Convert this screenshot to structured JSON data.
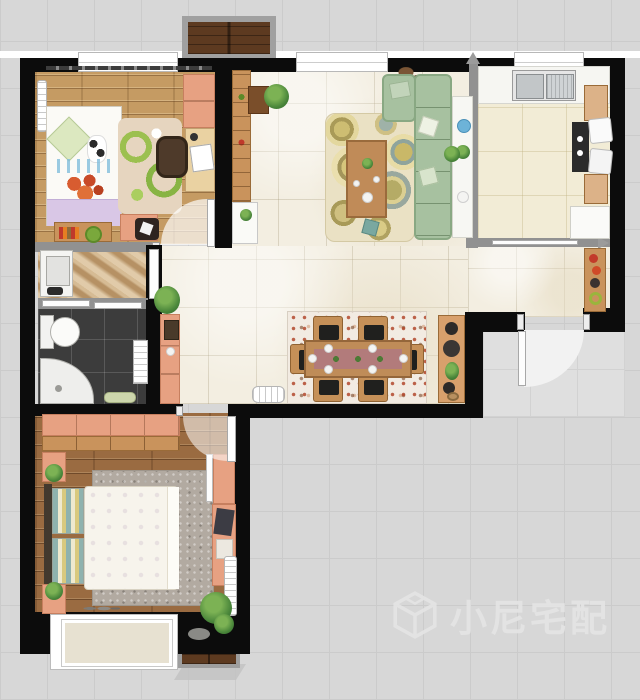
{
  "watermark": {
    "text": "小尼宅配",
    "logo": "cube-logo-icon",
    "color": "#e5e5e5"
  },
  "palette": {
    "exterior_bg": "#d7d7d7",
    "exterior_grid": "#cbcbcb",
    "wall_black": "#0c0c0c",
    "partition_gray": "#919191",
    "cream_marble_tile": "#f3eee1",
    "kitchen_tile": "#f2ecd6",
    "light_wood_floor": "#c59b63",
    "dark_wood_floor": "#9a6b41",
    "walnut_balcony": "#5d3a20",
    "marble_beige": "#c8a77a",
    "bath_tile_dark": "#3c3c3c",
    "fixture_white": "#ffffff",
    "sofa_green": "#a7c1a0",
    "salmon_furniture": "#e7a182",
    "furniture_wood": "#c9935c",
    "living_rug_base": "#eae1c4",
    "dining_rug_base": "#f2ebe2",
    "master_rug_gray": "#b2aaa1",
    "lavender_bedding": "#d9c7e6",
    "door_fan": "#f2f2f2"
  },
  "floorplan": {
    "rooms": [
      {
        "name": "secondary-bedroom",
        "floor": "light-wood-plank",
        "furniture": [
          "single-bed",
          "diamond-pillow",
          "flower-throw",
          "lavender-runner",
          "green-swirl-rug",
          "desk",
          "monitor",
          "desk-chair",
          "wardrobe",
          "radiator",
          "curtain-rail",
          "dresser",
          "side-table",
          "black-chair",
          "hinged-door"
        ]
      },
      {
        "name": "top-balcony",
        "floor": "walnut-plank",
        "furniture": []
      },
      {
        "name": "living-room",
        "floor": "cream-marble-tile",
        "furniture": [
          "l-shaped-green-sofa",
          "throw-pillows",
          "circle-pattern-rug",
          "coffee-table",
          "tea-set",
          "console-table",
          "blue-cup",
          "bookshelf",
          "low-cabinet",
          "bush-plant",
          "dried-plant",
          "teal-stool"
        ]
      },
      {
        "name": "kitchen",
        "floor": "cream-tile",
        "furniture": [
          "double-basin-sink",
          "counter",
          "cooktop",
          "breakfast-chairs",
          "wood-cabinet-upper",
          "wood-cabinet-lower",
          "white-cabinet",
          "sliding-door-vertical",
          "sliding-door-horizontal"
        ]
      },
      {
        "name": "entry-hall",
        "floor": "cream-marble-tile",
        "furniture": [
          "display-shelf",
          "red-flowers",
          "entry-door"
        ]
      },
      {
        "name": "hallway",
        "floor": "cream-marble-tile",
        "furniture": [
          "potted-plant",
          "hall-cabinet"
        ]
      },
      {
        "name": "dining-area",
        "floor": "cream-marble-tile",
        "furniture": [
          "dining-table",
          "table-runner",
          "dining-chairs-x6",
          "mosaic-rug",
          "sideboard",
          "white-radiator-bench"
        ]
      },
      {
        "name": "laundry-closet",
        "floor": "beige-marble",
        "furniture": [
          "washing-machine",
          "white-door",
          "sliding-partition"
        ]
      },
      {
        "name": "bathroom",
        "floor": "dark-gray-tile",
        "furniture": [
          "toilet",
          "corner-shower",
          "towel-shelf",
          "bath-mat"
        ]
      },
      {
        "name": "master-bedroom",
        "floor": "dark-wood-plank",
        "furniture": [
          "double-bed",
          "striped-pillows",
          "floral-duvet",
          "gray-speckle-rug",
          "wardrobe",
          "nightstand-x2",
          "potted-plants",
          "vanity-with-mirror",
          "daybed",
          "dark-pillows",
          "radiator",
          "large-plant",
          "decor-stones",
          "hinged-door",
          "bay-window"
        ]
      },
      {
        "name": "bottom-balcony",
        "floor": "walnut-plank",
        "furniture": []
      }
    ]
  }
}
